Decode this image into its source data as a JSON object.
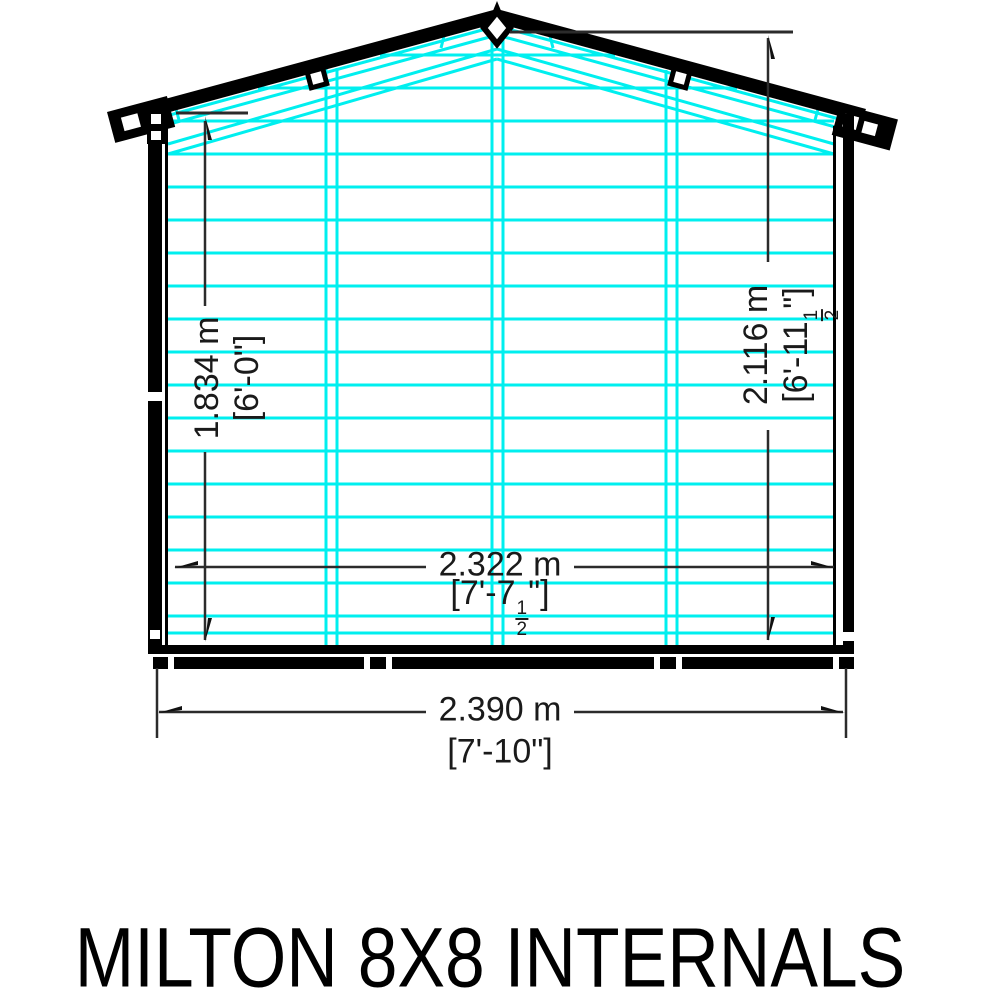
{
  "title": "MILTON 8X8 INTERNALS",
  "dimensions": {
    "eaves_height": {
      "metric": "1.834 m",
      "imperial": "[6'-0\"]"
    },
    "ridge_height": {
      "metric": "2.116 m",
      "imperial_pre": "[6'-11",
      "fraction_numerator": "1",
      "fraction_denominator": "2",
      "imperial_post": "\"]"
    },
    "internal_width": {
      "metric": "2.322 m",
      "imperial_pre": "[7'-7",
      "fraction_numerator": "1",
      "fraction_denominator": "2",
      "imperial_post": "\"]"
    },
    "external_width": {
      "metric": "2.390 m",
      "imperial": "[7'-10\"]"
    }
  },
  "colors": {
    "internal_framing": "#00efef",
    "structure": "#000000",
    "dimension_lines": "#2b2b2b"
  }
}
